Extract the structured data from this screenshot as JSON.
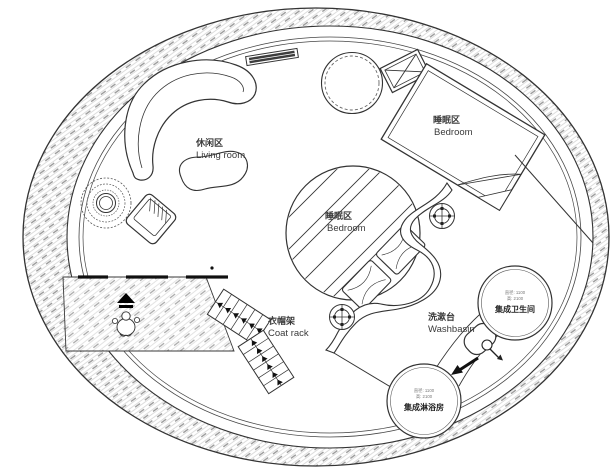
{
  "title": "circular-tiny-house-floor-plan",
  "colors": {
    "line": "#333333",
    "hatch_fine": "#cfcfcf",
    "hatch_dash": "#9a9a9a",
    "text": "#3a3a3a",
    "spec_text": "#777777",
    "door_bar": "#101010",
    "background": "#ffffff"
  },
  "areas": {
    "living_room": {
      "label_zh": "休闲区",
      "label_en": "Living room"
    },
    "bedroom_main": {
      "label_zh": "睡眠区",
      "label_en": "Bedroom"
    },
    "bedroom_loft": {
      "label_zh": "睡眠区",
      "label_en": "Bedroom"
    },
    "coat_rack": {
      "label_zh": "衣帽架",
      "label_en": "Coat rack"
    },
    "washbasin": {
      "label_zh": "洗漱台",
      "label_en": "Washbasin"
    },
    "bathroom_pod": {
      "spec_line1": "直径: 1100",
      "spec_line2": "高: 2100",
      "label_zh": "集成卫生间"
    },
    "shower_pod": {
      "spec_line1": "直径: 1100",
      "spec_line2": "高: 2100",
      "label_zh": "集成淋浴房"
    }
  },
  "symbols": {
    "outer_wall": "hatched ring wall",
    "entrance_ramp": "hatched entry floor with direction arrow and person figure",
    "sofa": "curved crescent sofa",
    "coffee_table": "kidney shaped table",
    "plant": "potted plant",
    "armchair": "rotated armchair",
    "wall_shelf": "thin wall-mounted shelf",
    "round_rug": "round rug / table",
    "ac_unit": "equipment box with X",
    "bed": "double bed with folded duvet corner",
    "loft_circle": "striped loft bedroom circle with pillows",
    "wavy_partition": "freeform wavy partition wall",
    "target_marker": "crosshair column/light marker",
    "basin": "counter basin with faucet",
    "flow_arrow": "solid direction arrow"
  }
}
